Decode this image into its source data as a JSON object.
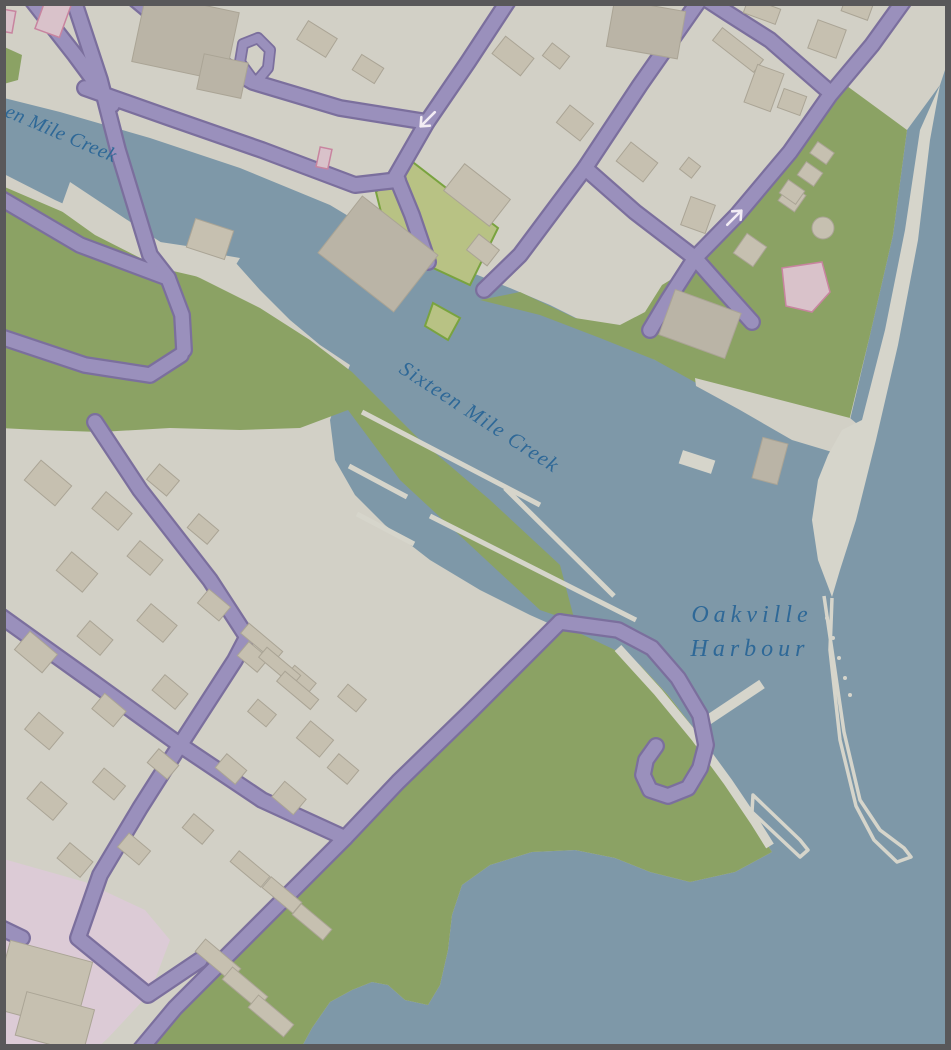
{
  "map": {
    "title": "Oakville Harbour map view",
    "labels": {
      "creek_partial": {
        "text": "en Mile Creek",
        "rotation_deg": 23
      },
      "creek_main": {
        "text": "Sixteen Mile Creek",
        "rotation_deg": 33
      },
      "harbour": {
        "line1": "Oakville",
        "line2": "Harbour"
      }
    },
    "markers": {
      "oneway_arrows": [
        {
          "name": "one-way-arrow-southwest",
          "x": 427,
          "y": 120,
          "direction": "southwest"
        },
        {
          "name": "one-way-arrow-northeast",
          "x": 735,
          "y": 217,
          "direction": "northeast"
        }
      ]
    },
    "colors": {
      "land": "#d2d0c6",
      "water": "#7e98a8",
      "park": "#8ba264",
      "field": "#b8c284",
      "field_outline": "#79a33f",
      "road": "#9a90bc",
      "road_casing": "#7b6f9d",
      "building": "#c6c0b0",
      "building_dark": "#bab4a6",
      "building_outline": "#aaa495",
      "pink_zone": "#dccbd6",
      "pink_building": "#d9c2ca",
      "pink_building_outline": "#c8849f",
      "path": "#d6d5cb",
      "label": "#2e6897",
      "arrow": "#f2ecf4",
      "frame": "#59585a"
    }
  }
}
